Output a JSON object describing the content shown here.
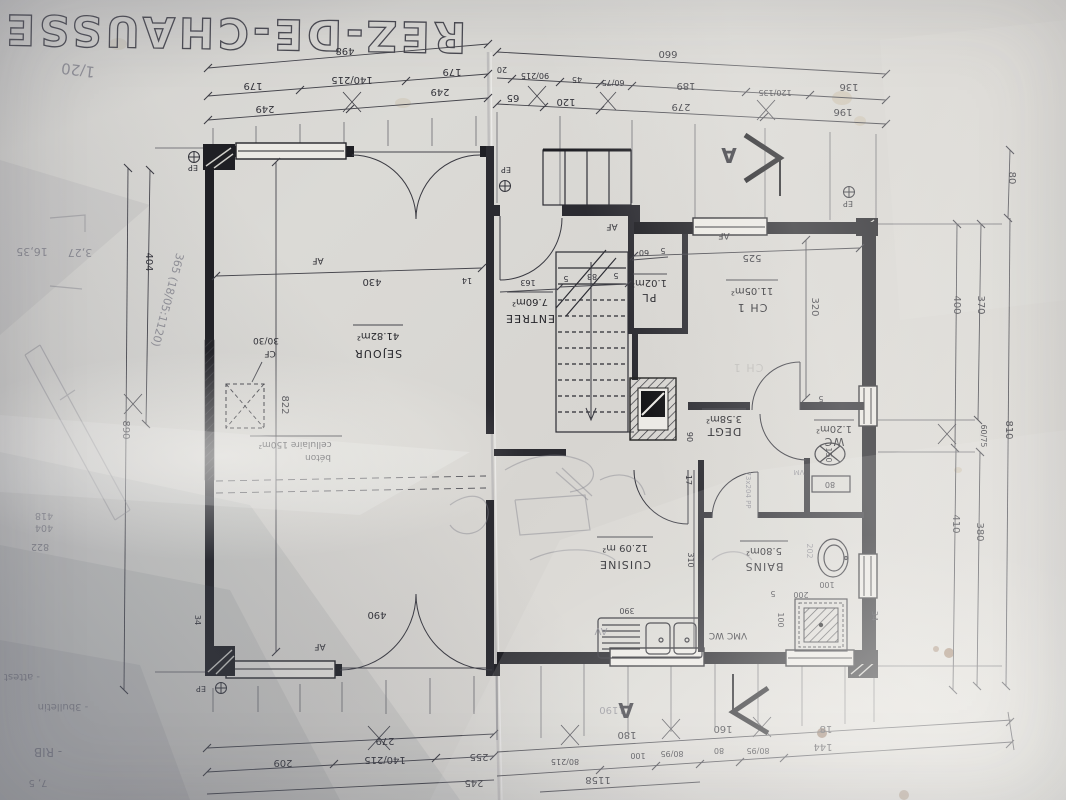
{
  "photo": {
    "title": "REZ-DE-CHAUSSEE"
  },
  "rooms": {
    "sejour": {
      "name": "SEJOUR",
      "area": "41.82m²"
    },
    "entree": {
      "name": "ENTREE",
      "area": "7.60m²"
    },
    "pl": {
      "name": "PL",
      "area": "1.02m²"
    },
    "ch1": {
      "name": "CH 1",
      "area": "11.05m²"
    },
    "degt": {
      "name": "DEGT",
      "area": "3.58m²"
    },
    "wc": {
      "name": "WC",
      "area": "1.20m²"
    },
    "cuisine": {
      "name": "CUISINE",
      "area": "12.09 m²"
    },
    "bains": {
      "name": "BAINS",
      "area": "5.80m²"
    }
  },
  "labels": {
    "af": "AF",
    "ep": "EP",
    "cf_top": "30/30",
    "cf": "CF",
    "beton": "béton",
    "beton2": "cellulaire 150m²",
    "vmc": "VMC WC",
    "section": "A"
  },
  "dims": {
    "tl": {
      "total": "498",
      "d1": "179",
      "d2": "140/215",
      "d3": "179",
      "d4": "249",
      "d5": "249"
    },
    "tr": {
      "total": "660",
      "d1": "20",
      "d2": "90/215",
      "d3": "45",
      "d4": "60/75",
      "d5": "189",
      "d6": "120/135",
      "d7": "136",
      "d8": "65",
      "d9": "120",
      "d10": "279",
      "d11": "196"
    },
    "lv": {
      "d1": "404",
      "d2": "890",
      "d3": "34"
    },
    "rv": {
      "d1": "80",
      "d2": "370",
      "d3": "400",
      "d4": "60/75",
      "d5": "810",
      "d6": "380",
      "d7": "410"
    },
    "bl": {
      "d1": "279",
      "d2": "209",
      "d3": "140/215",
      "d4": "255",
      "d5": "245"
    },
    "br": {
      "d1": "180",
      "d2": "160",
      "d3": "18",
      "d4": "80/215",
      "d5": "100",
      "d6": "80/95",
      "d7": "80",
      "d8": "80/95",
      "d9": "144",
      "total": "1158"
    },
    "inner": {
      "sejour_w": "430",
      "n14": "14",
      "sejour_h": "822",
      "entree_w": "163",
      "s5a": "5",
      "s83": "83",
      "s5b": "5",
      "pl60": "60",
      "pl5": "5",
      "ch1w": "525",
      "ch1h": "320",
      "degt": "90",
      "wc150": "150",
      "wc80": "80",
      "cui310": "310",
      "sink390": "390",
      "b100a": "100",
      "b100b": "100",
      "b200": "200",
      "b5a": "5",
      "b5b": "5",
      "hall17": "17",
      "out34r": "34",
      "out34l": "34",
      "door490": "490"
    }
  },
  "pencil": {
    "scale": "1/20",
    "calc_a": "3,27",
    "calc_b": "16,35",
    "win": "365 (18/05:1120)",
    "col_a": "418",
    "col_b": "404",
    "col_c": "822",
    "note1": "- RIB",
    "note2": "- 3bulletin",
    "note3": "- attest",
    "note4": "7, 5",
    "door": "73x204 PP",
    "av": "AV",
    "vm": "VM",
    "m202": "202",
    "n1190": "1190",
    "ghost": "CH 1"
  }
}
